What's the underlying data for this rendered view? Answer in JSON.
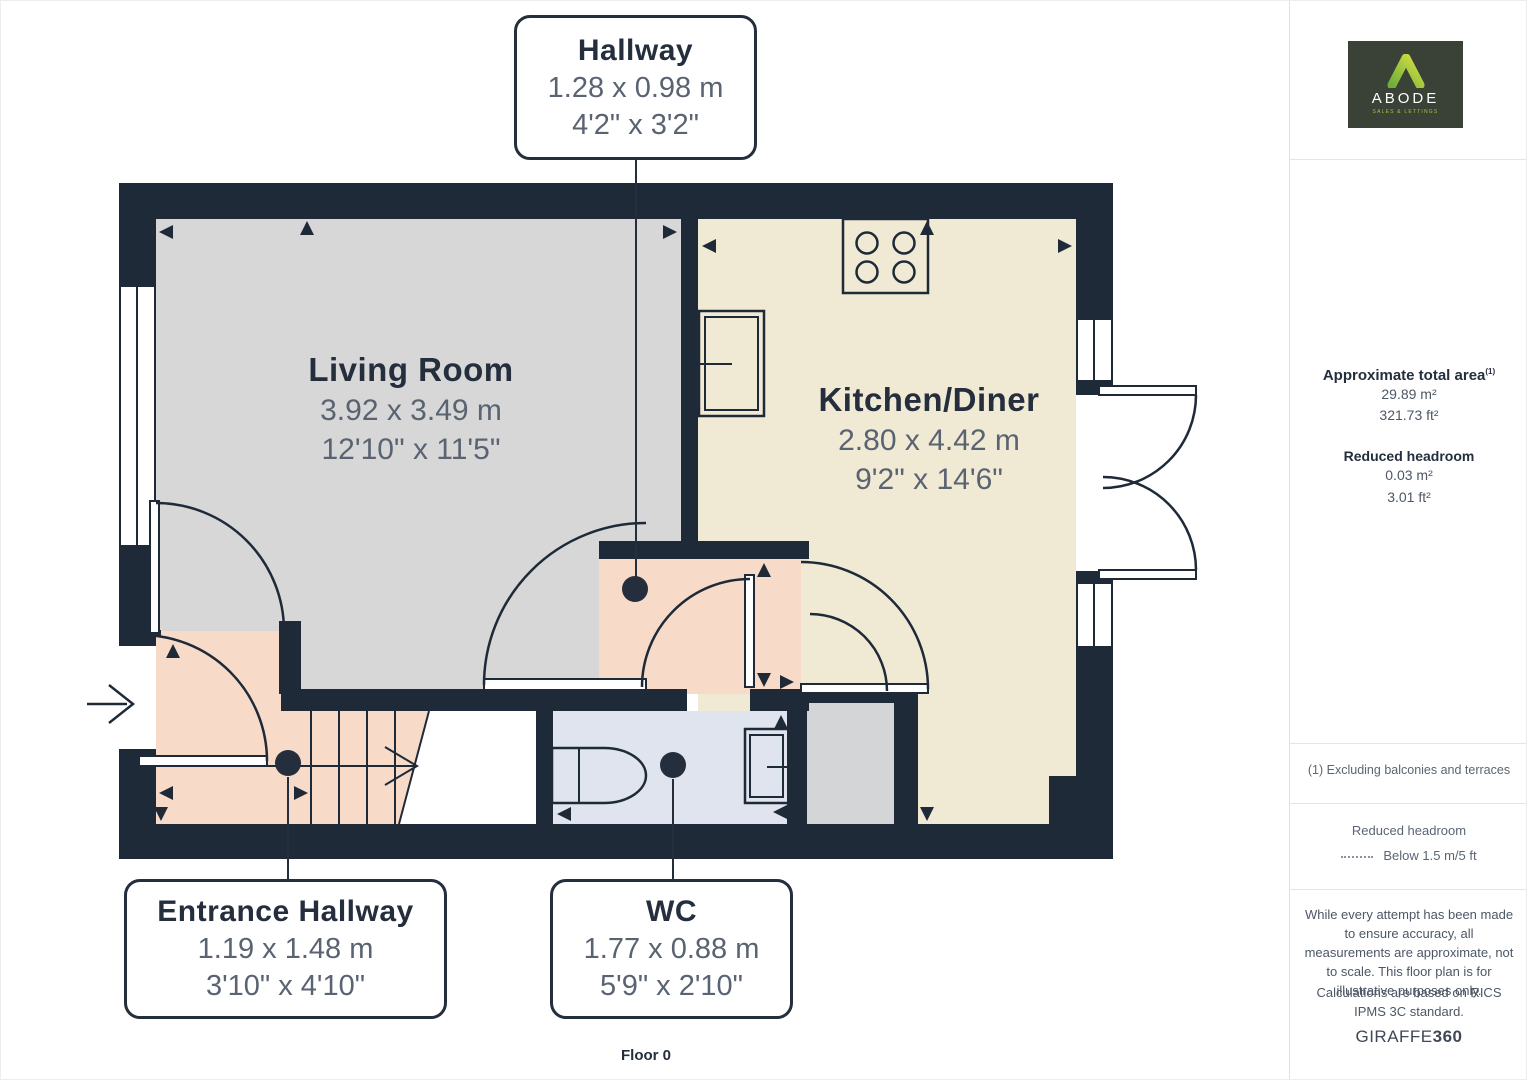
{
  "plan": {
    "floor_label": "Floor 0"
  },
  "rooms": {
    "living_room": {
      "name": "Living Room",
      "metric": "3.92 x 3.49 m",
      "imperial": "12'10\" x 11'5\""
    },
    "kitchen_diner": {
      "name": "Kitchen/Diner",
      "metric": "2.80 x 4.42 m",
      "imperial": "9'2\" x 14'6\""
    },
    "hallway": {
      "name": "Hallway",
      "metric": "1.28 x 0.98 m",
      "imperial": "4'2\" x 3'2\""
    },
    "entrance_hallway": {
      "name": "Entrance Hallway",
      "metric": "1.19 x 1.48 m",
      "imperial": "3'10\" x 4'10\""
    },
    "wc": {
      "name": "WC",
      "metric": "1.77 x 0.88 m",
      "imperial": "5'9\" x 2'10\""
    }
  },
  "sidebar": {
    "logo": {
      "brand": "ABODE",
      "tagline": "SALES & LETTINGS"
    },
    "area": {
      "title": "Approximate total area",
      "sup": "(1)",
      "m2": "29.89 m²",
      "ft2": "321.73 ft²"
    },
    "headroom": {
      "title": "Reduced headroom",
      "m2": "0.03 m²",
      "ft2": "3.01 ft²"
    },
    "footnote": "(1) Excluding balconies and terraces",
    "legend": {
      "title": "Reduced headroom",
      "label": "Below 1.5 m/5 ft"
    },
    "disclaimer_1": "While every attempt has been made to ensure accuracy, all measurements are approximate, not to scale. This floor plan is for illustrative purposes only.",
    "disclaimer_2": "Calculations are based on RICS IPMS 3C standard.",
    "brand": {
      "name": "GIRAFFE",
      "suffix": "360"
    }
  },
  "colors": {
    "wall": "#1f2a38",
    "living_room_fill": "#d6d7d6",
    "kitchen_fill": "#f0ead4",
    "hallway_fill": "#f7dbc8",
    "wc_fill": "#e0e4ee",
    "closet_fill": "#d4d5d6",
    "logo_green": "#a3c53f",
    "logo_bg": "#3a4136"
  }
}
